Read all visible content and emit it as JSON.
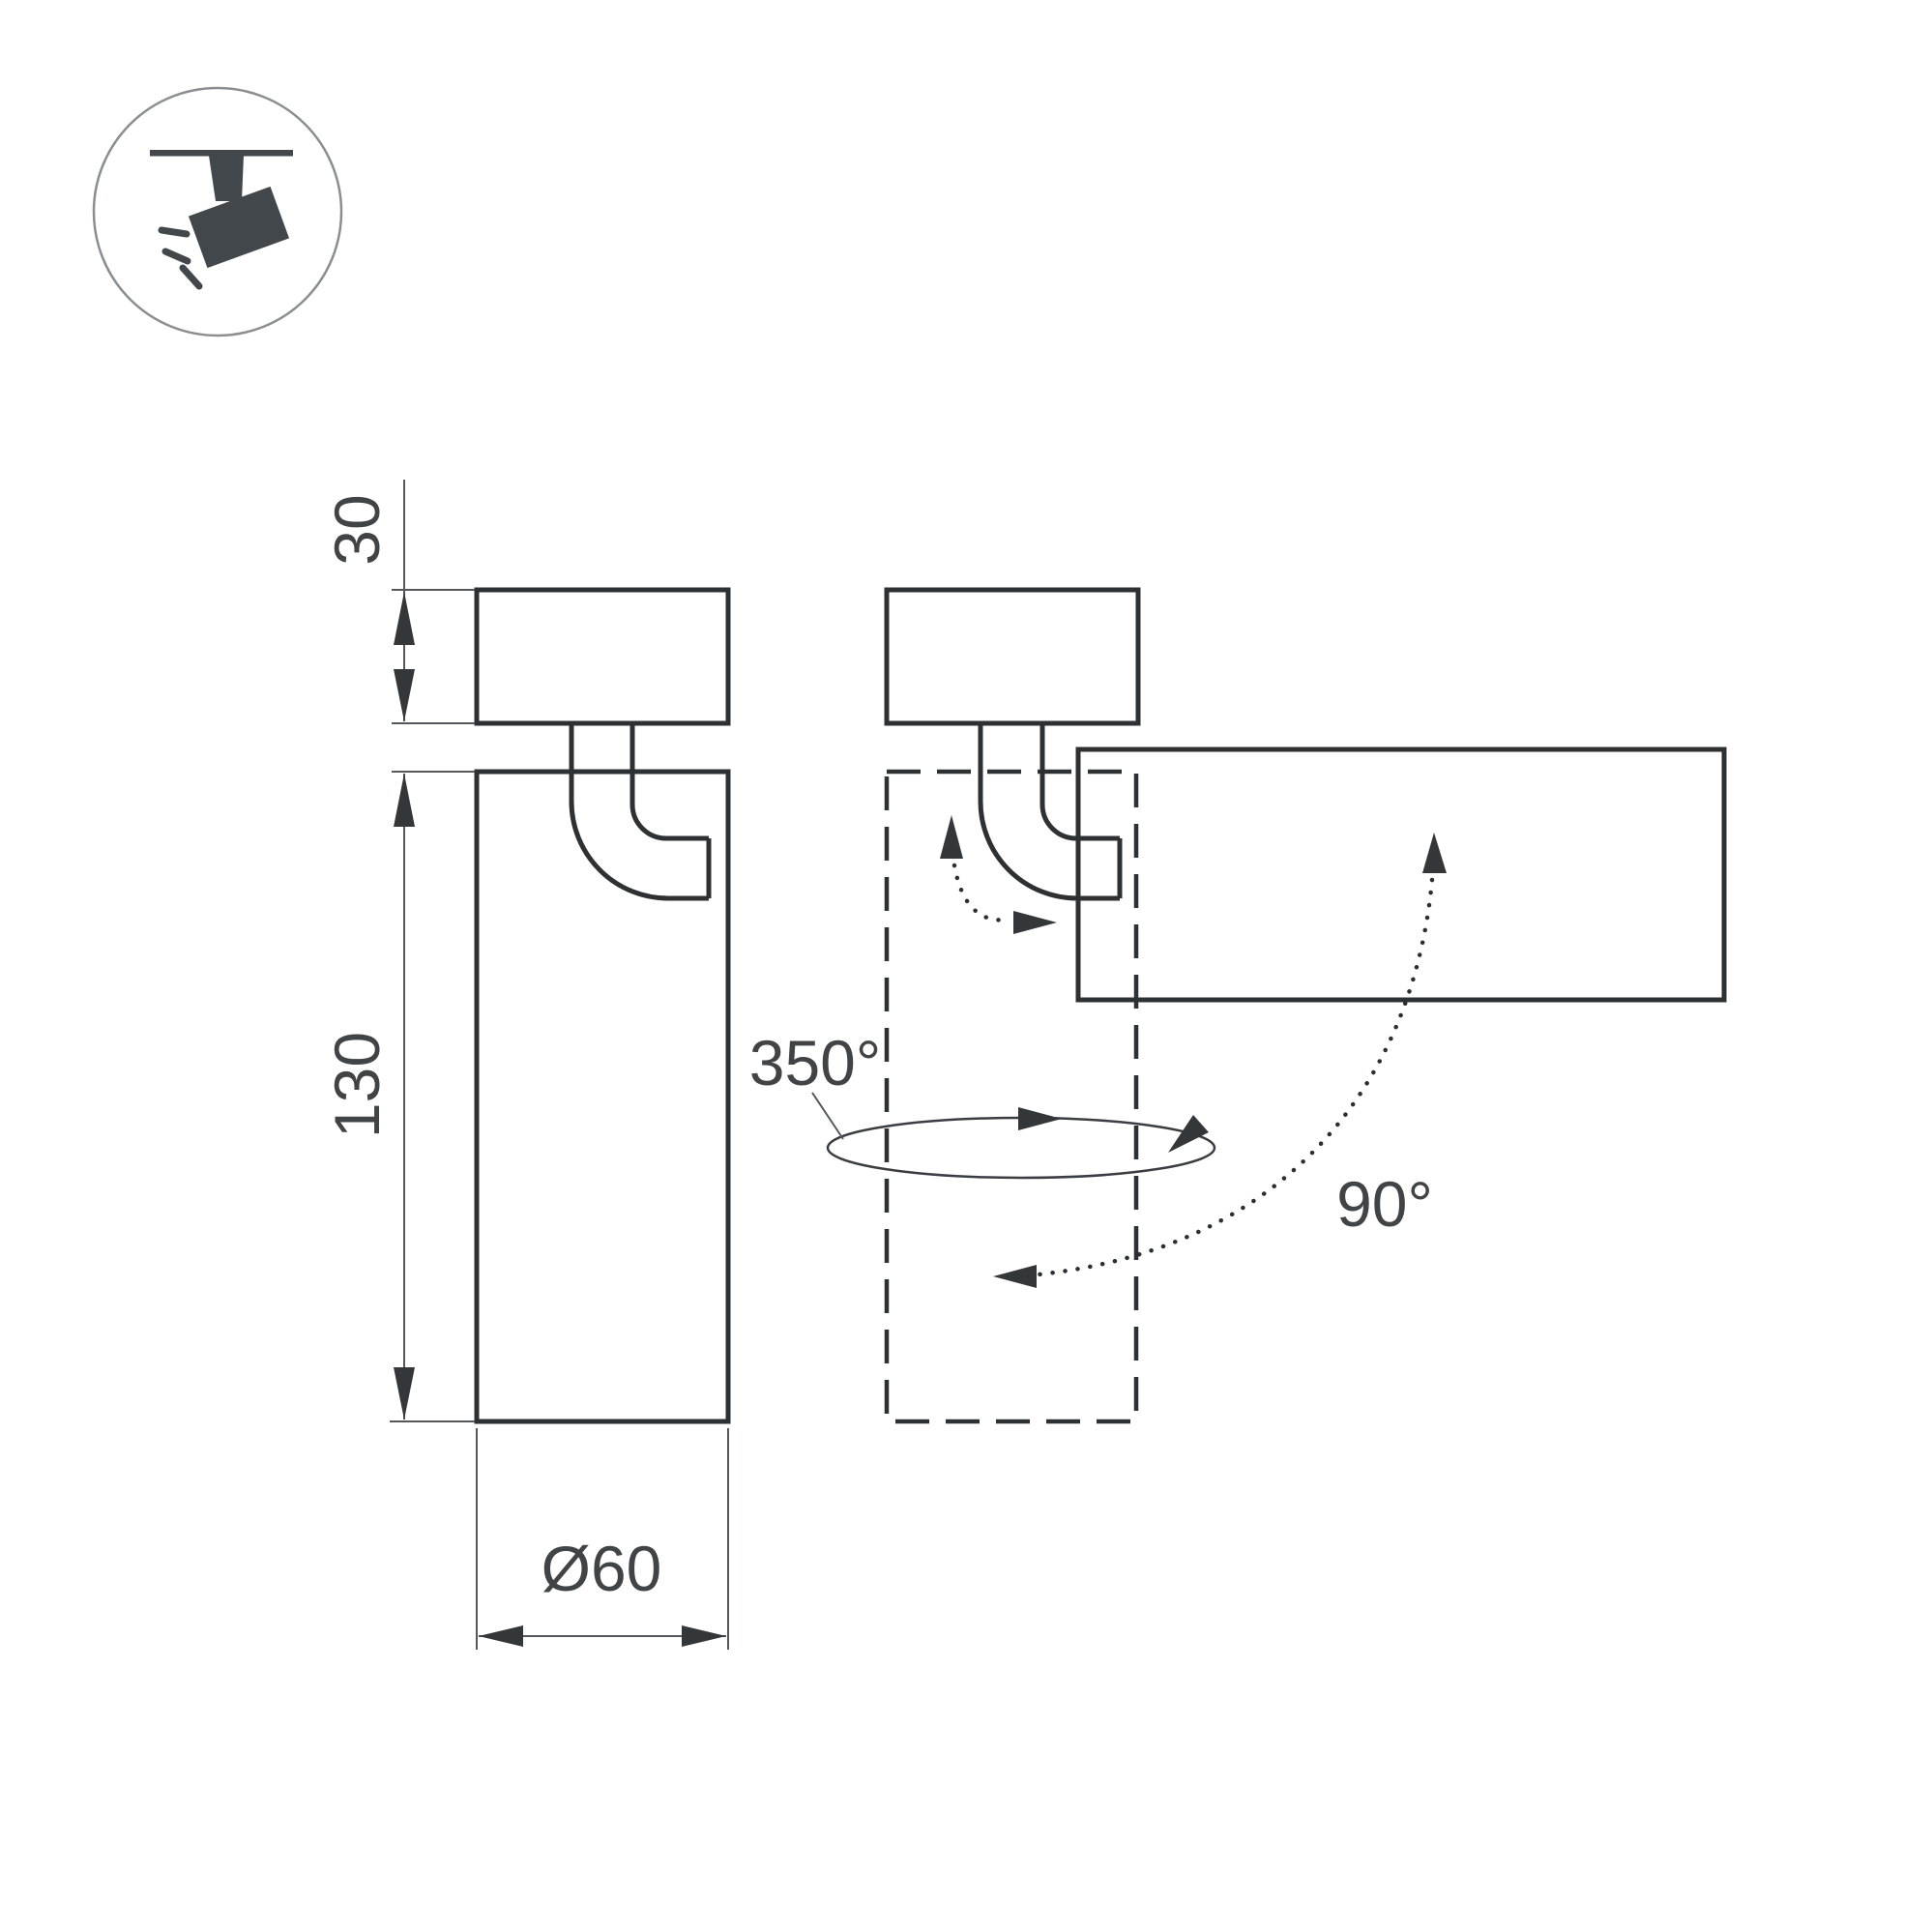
{
  "diagram": {
    "type": "technical-dimension-drawing",
    "subject": "ceiling-mounted track spotlight with rotating head",
    "views": {
      "front_view": "cylindrical body hanging from mount via curved yoke arm",
      "rotated_view": "dashed ghost of vertical body plus solid body tilted 90 degrees horizontal"
    },
    "labels": {
      "mount_height": "30",
      "body_length": "130",
      "diameter": "Ø60",
      "rotation_range": "350°",
      "tilt_range": "90°"
    },
    "colors": {
      "background": "#ffffff",
      "outline": "#2e3134",
      "dimension_line": "#54585c",
      "text": "#404447",
      "icon": "#42474b",
      "icon_circle": "#8b8e91"
    }
  }
}
